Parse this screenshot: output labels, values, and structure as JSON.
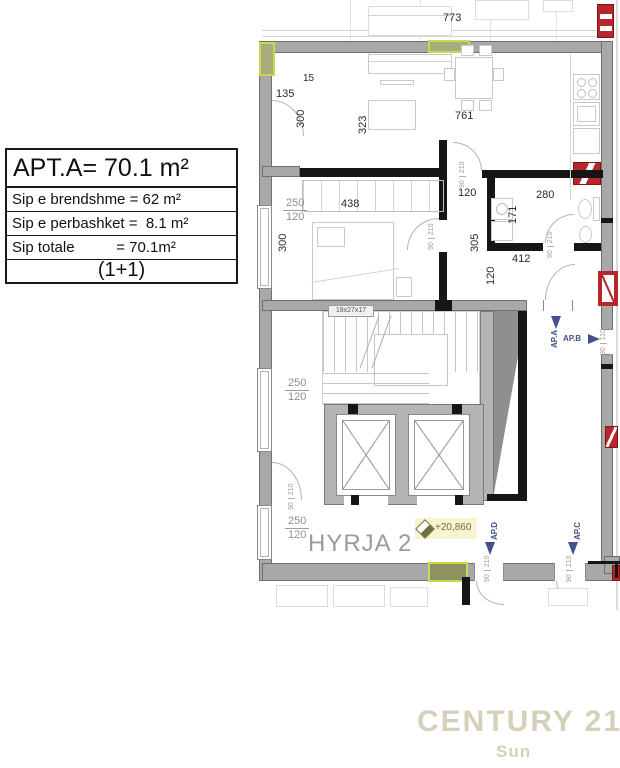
{
  "info_box": {
    "title": "APT.A= 70.1 m²",
    "rows": [
      "Sip e brendshme = 62 m²",
      "Sip e perbashket =  8.1 m²",
      "Sip totale          = 70.1m²"
    ],
    "unit_type": "(1+1)"
  },
  "plan": {
    "dims": {
      "d773": "773",
      "d135": "135",
      "d15": "15",
      "d300": "300",
      "d323": "323",
      "d761": "761",
      "d438": "438",
      "d120": "120",
      "d250": "250",
      "d280": "280",
      "d171": "171",
      "d305": "305",
      "d412": "412"
    },
    "door_dim": {
      "w": "90",
      "h": "210"
    },
    "win_dim": {
      "w": "90",
      "h": "110"
    },
    "stair_label": "18x27x17",
    "lobby_name": "HYRJA 2",
    "level_mark": "+20,860",
    "unit_labels": {
      "a": "AP.A",
      "b": "AP.B",
      "c": "AP.C",
      "d": "AP.D"
    }
  },
  "watermark": {
    "brand": "CENTURY 21",
    "sub": "Sun"
  },
  "colors": {
    "wall_gray": "#a8a8a8",
    "interior_black": "#161616",
    "highlight_green": "#c6d94f",
    "marker_red": "#b8262b",
    "arrow_blue": "#44508e",
    "level_yellow": "#f7f4cf",
    "brand_beige": "#d6d0bb"
  }
}
